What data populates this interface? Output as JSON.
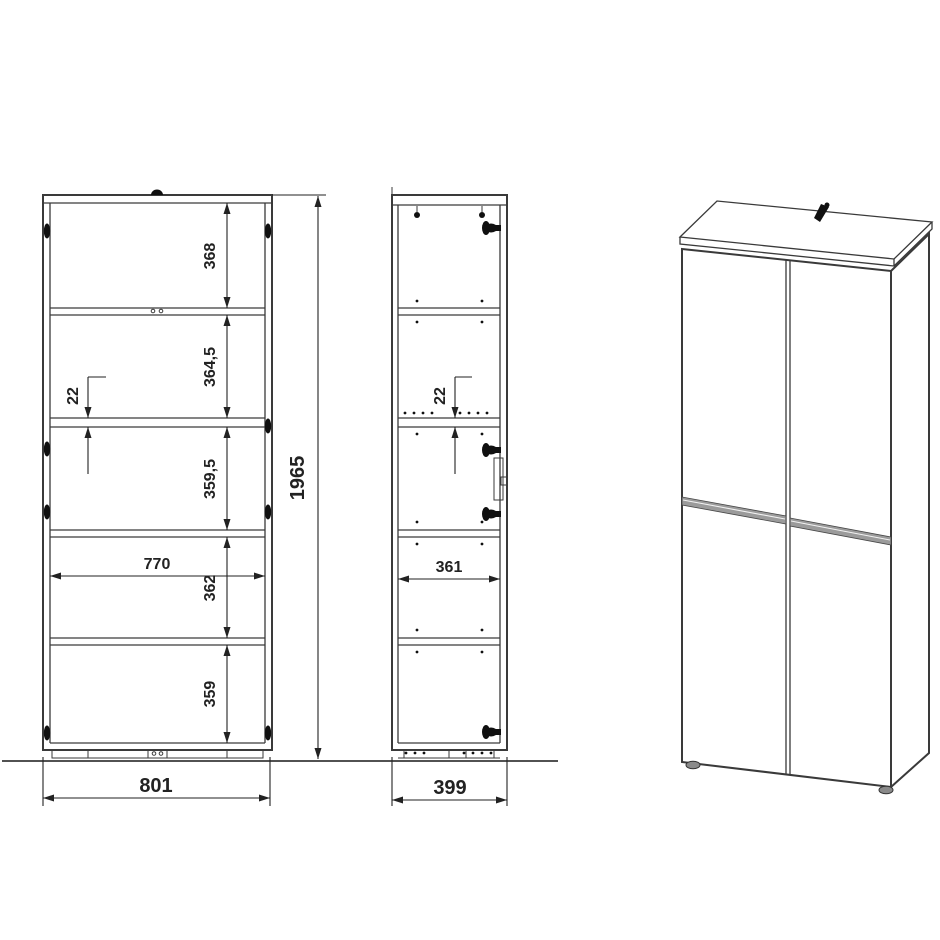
{
  "drawing": {
    "type": "furniture-technical-drawing",
    "views": {
      "front": {
        "height_total": "1965",
        "width_total": "801",
        "inner_width": "770",
        "shelf_thickness": "22",
        "compartments": [
          "368",
          "364,5",
          "359,5",
          "362",
          "359"
        ]
      },
      "side": {
        "width_total": "399",
        "inner_depth": "361",
        "shelf_thickness": "22"
      },
      "perspective": {
        "description": "3d-view-four-door-cabinet"
      }
    }
  },
  "colors": {
    "bg": "#ffffff",
    "line": "#3a3a3a",
    "dim": "#222222",
    "hardware": "#101010",
    "strip": "#9b9b9b"
  }
}
